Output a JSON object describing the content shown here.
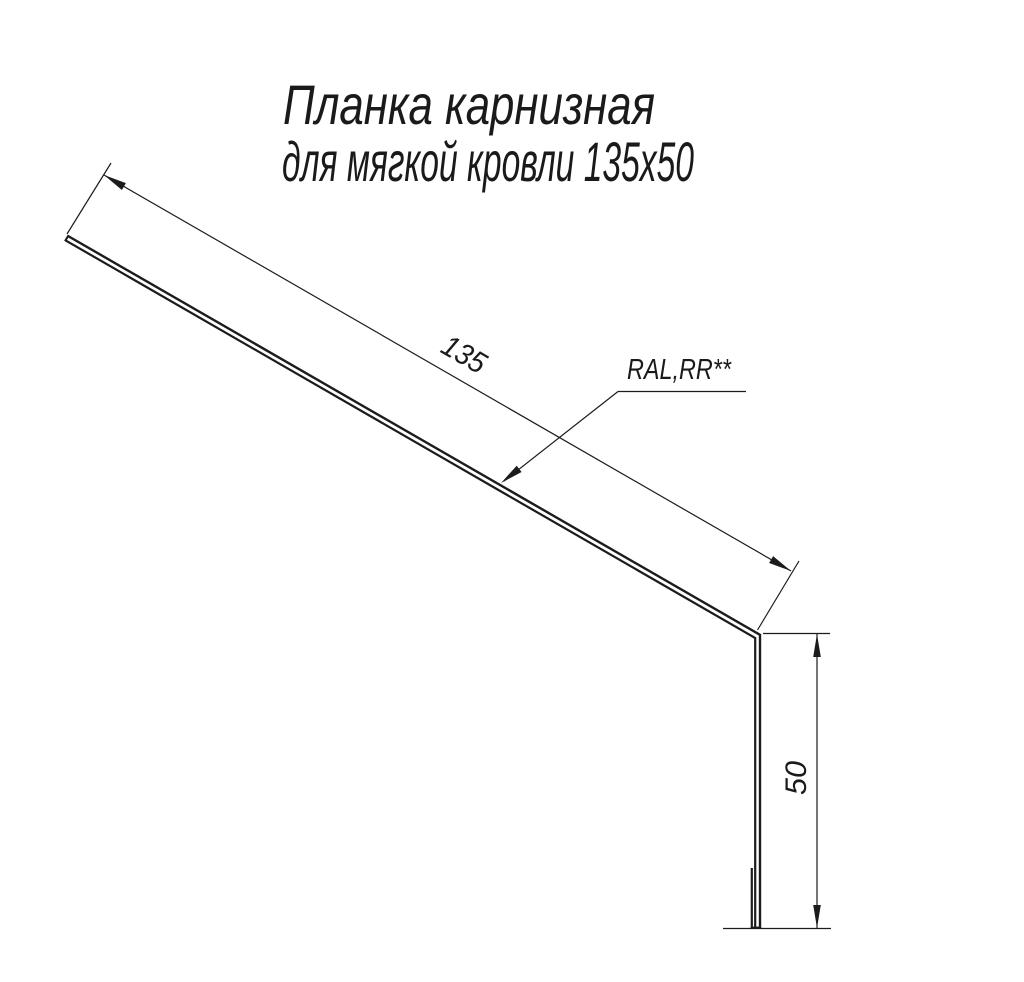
{
  "drawing": {
    "title": {
      "line1": "Планка карнизная",
      "line2": "для мягкой кровли 135х50"
    },
    "labels": {
      "length_dim": "135",
      "height_dim": "50",
      "coating": "RAL,RR**"
    },
    "colors": {
      "line": "#1c1c1c",
      "text": "#1a1a1a",
      "background": "#ffffff"
    }
  }
}
